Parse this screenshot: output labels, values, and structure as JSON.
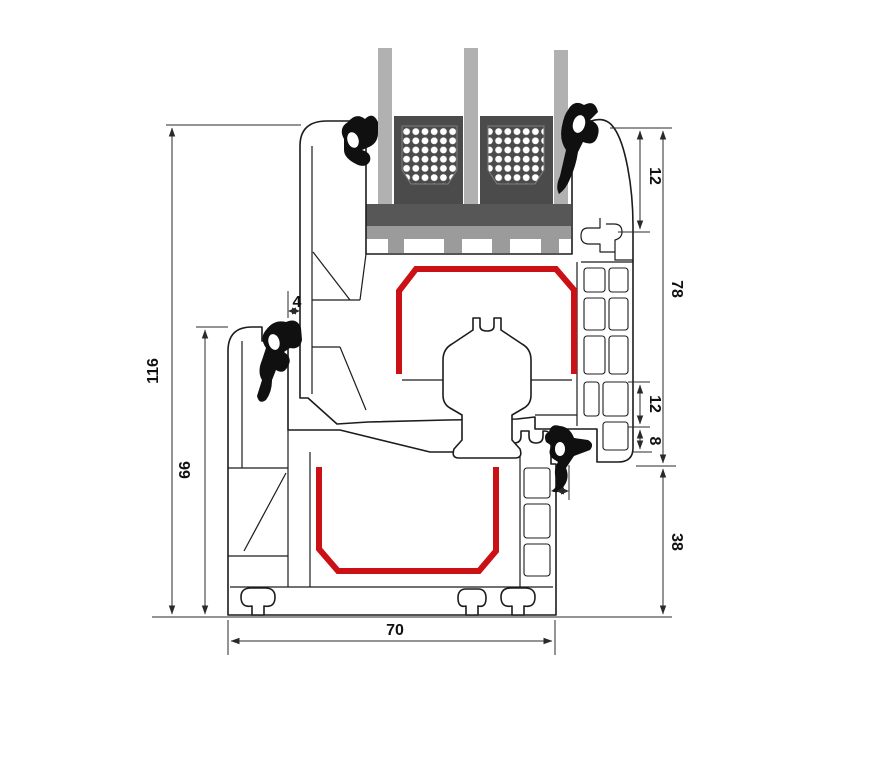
{
  "figure": {
    "type": "technical-cross-section",
    "description": "Window profile section: sash with triple glazing sitting on frame, steel reinforcement shown in red, rubber gaskets in black"
  },
  "dimensions": {
    "overall_height": "116",
    "frame_height": "66",
    "sash_glazing_height": "78",
    "glass_edge_cover": "12",
    "hardware_offset": "12",
    "hardware_depth": "8",
    "gap_top": "4",
    "gap_middle": "4",
    "frame_lower_height": "38",
    "profile_depth": "70"
  },
  "colors": {
    "steel_red": "#cb1016",
    "gasket_black": "#101010",
    "glass_gray": "#b1b1b1",
    "spacer_dark": "#4b4b4b",
    "setting_block": "#575757",
    "bridge_gray": "#9b9b9b",
    "outline": "#1c1c1c"
  },
  "components": [
    "triple-glazing",
    "spacer-bars",
    "setting-block",
    "glazing-bridge",
    "sash-profile",
    "frame-profile",
    "steel-reinforcement-sash",
    "steel-reinforcement-frame",
    "gaskets",
    "screw-boss",
    "hardware-groove"
  ]
}
